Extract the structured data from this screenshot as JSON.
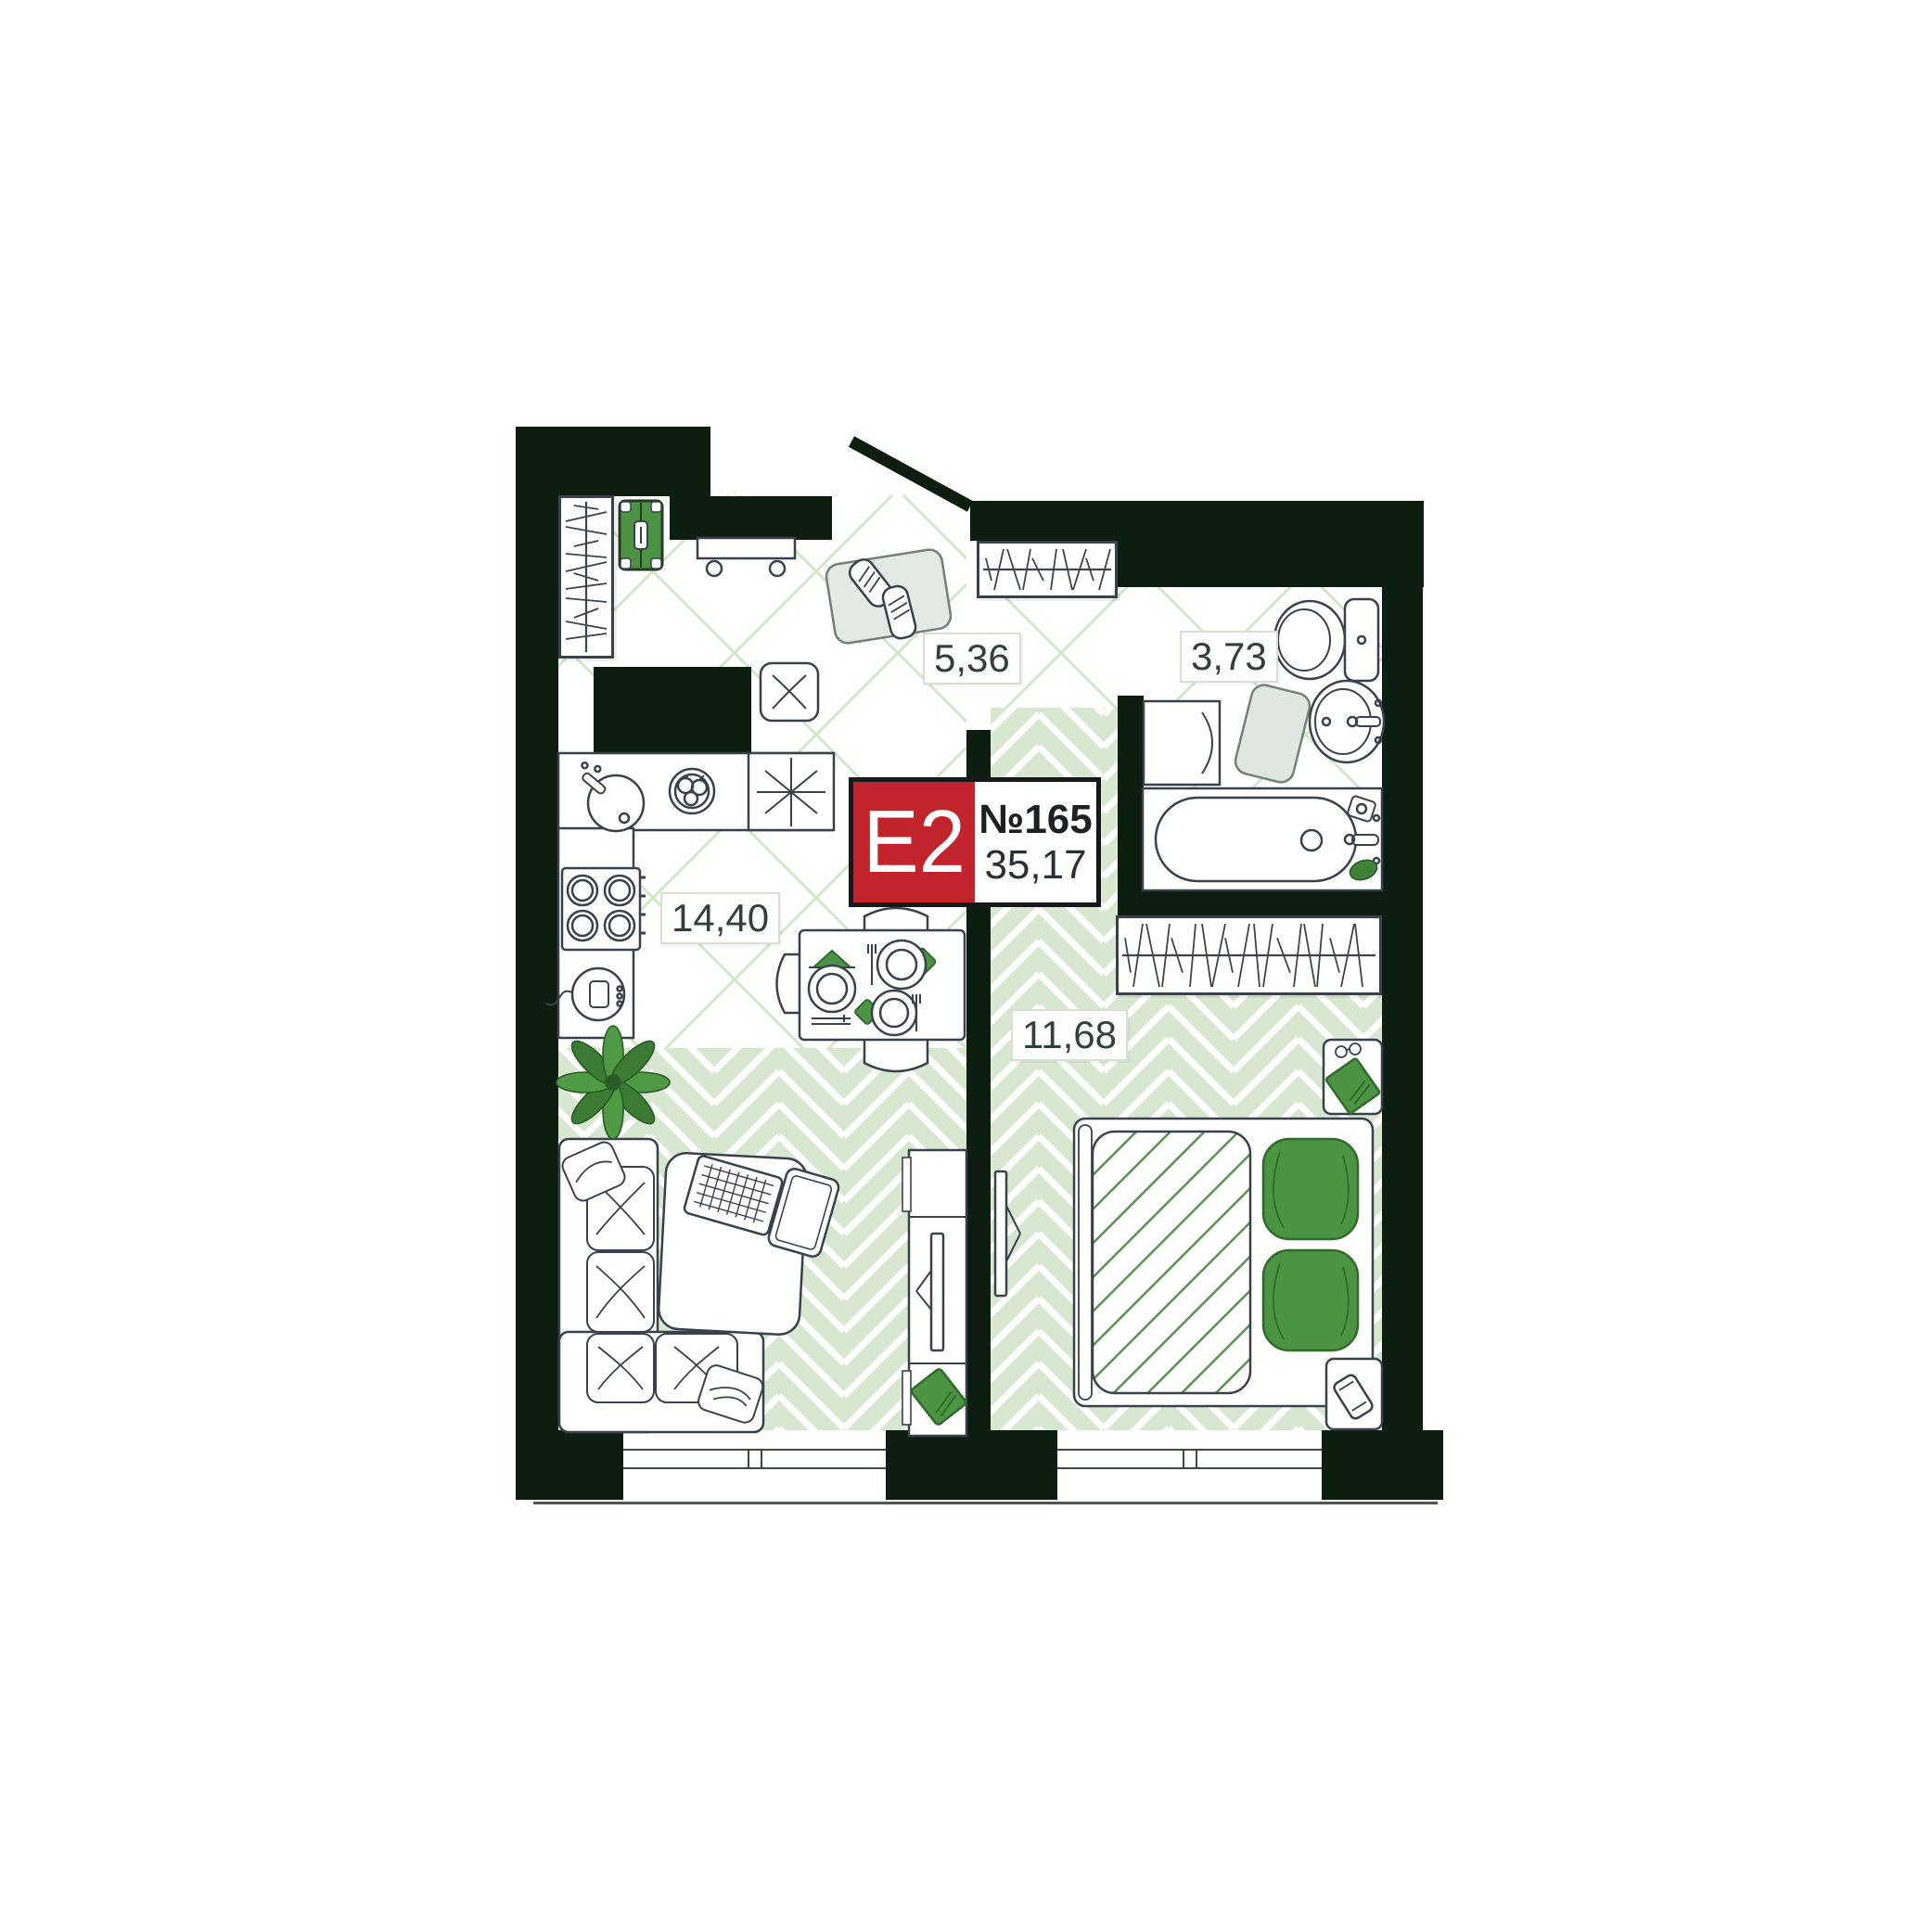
{
  "floorplan": {
    "badge": {
      "layout_code": "E2",
      "unit_number": "№165",
      "total_area": "35,17"
    },
    "rooms": [
      {
        "name": "hallway",
        "area": "5,36"
      },
      {
        "name": "bathroom",
        "area": "3,73"
      },
      {
        "name": "kitchen-living-room",
        "area": "14,40"
      },
      {
        "name": "bedroom",
        "area": "11,68"
      }
    ],
    "colors": {
      "walls": "#0d1d10",
      "badge_red": "#c2242b",
      "accent_green": "#4c9343",
      "floor_green": "#d8e7d0",
      "tile_line_green": "#cfe9c6"
    }
  }
}
